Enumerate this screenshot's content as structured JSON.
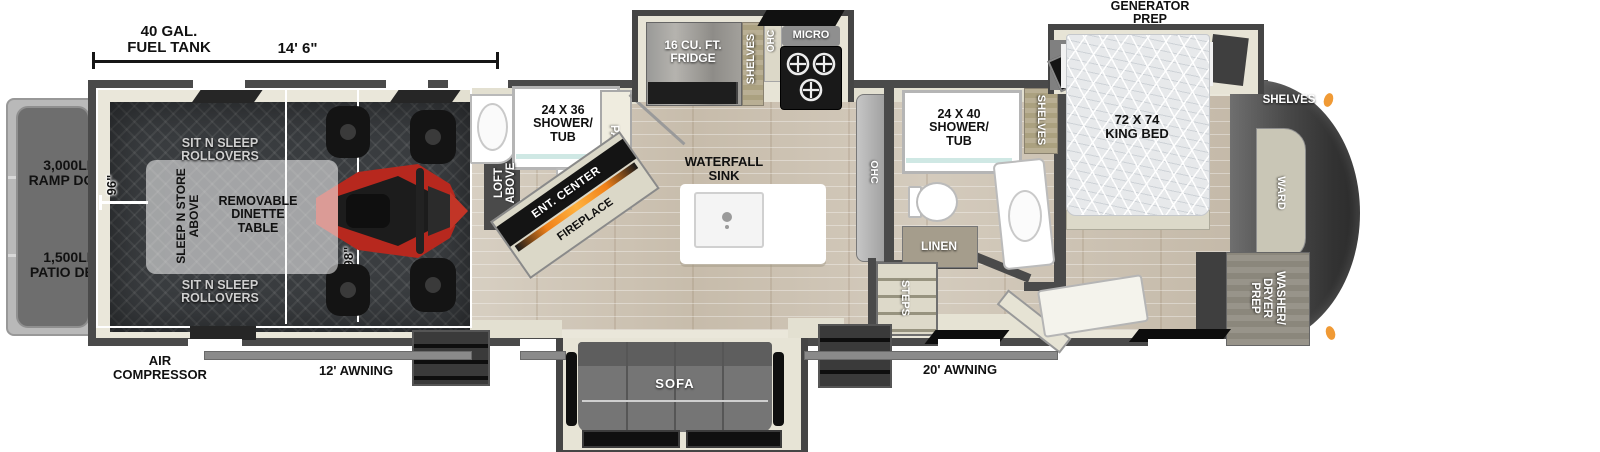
{
  "dimensions": {
    "fuel_tank": "40 GAL.\nFUEL TANK",
    "length": "14' 6\"",
    "garage_width": "96\"",
    "body_width": "98\""
  },
  "exterior": {
    "ramp_door": "3,000LB.\nRAMP DOOR",
    "patio_deck": "1,500LB.\nPATIO DECK",
    "air_compressor": "AIR\nCOMPRESSOR",
    "awning_rear": "12' AWNING",
    "awning_main": "20' AWNING",
    "generator_prep": "GENERATOR\nPREP"
  },
  "garage": {
    "rollovers_top": "SIT N SLEEP\nROLLOVERS",
    "rollovers_bottom": "SIT N SLEEP\nROLLOVERS",
    "sleep_n_store": "SLEEP N STORE\nABOVE",
    "dinette": "REMOVABLE\nDINETTE\nTABLE"
  },
  "rear_bath": {
    "shower": "24 X 36\nSHOWER/\nTUB",
    "loft": "LOFT\nABOVE"
  },
  "kitchen": {
    "pantry": "PANTRY",
    "ent_center": "ENT. CENTER",
    "fireplace": "FIREPLACE",
    "fridge": "16 CU. FT.\nFRIDGE",
    "shelves": "SHELVES",
    "ohc_upper": "OHC",
    "micro": "MICRO",
    "waterfall_sink": "WATERFALL\nSINK",
    "ohc_counter": "OHC"
  },
  "living": {
    "sofa": "SOFA"
  },
  "bath": {
    "shower": "24 X 40\nSHOWER/\nTUB",
    "shelves": "SHELVES",
    "linen": "LINEN",
    "steps": "STEPS"
  },
  "bedroom": {
    "bed": "72 X 74\nKING BED",
    "shelves_front": "SHELVES",
    "ward": "WARD",
    "washer_dryer": "WASHER/\nDRYER\nPREP"
  },
  "colors": {
    "wall": "#4a4a4a",
    "floor_beige": "#eae7da",
    "fireplace_accent": "#f08018",
    "marker_light": "#f09a35",
    "atv_red": "#b7281e"
  }
}
